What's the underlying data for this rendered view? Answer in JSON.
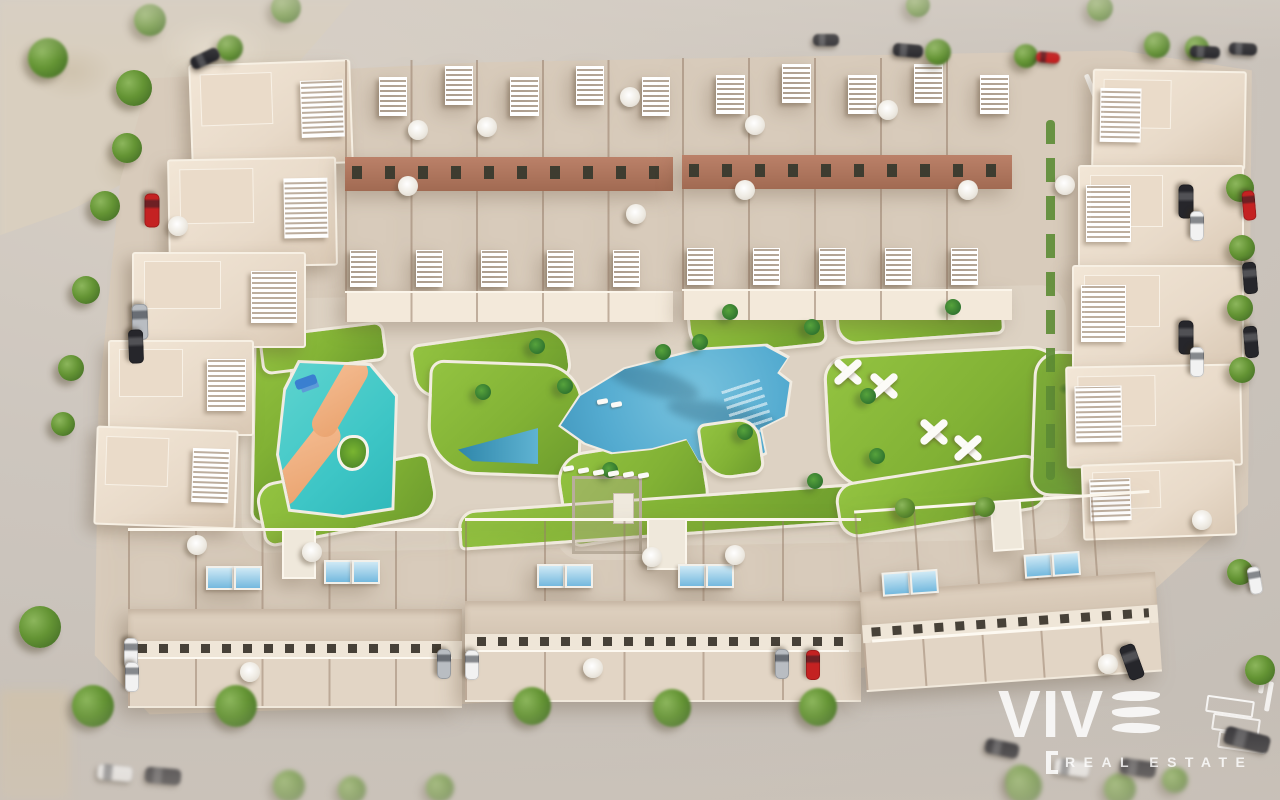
{
  "watermark": {
    "brand": "VIV",
    "tagline": "REAL ESTATE",
    "bracket": "["
  },
  "palette": {
    "street": "#cbc4bc",
    "ground": "#d8cbbb",
    "path": "#ddd2c3",
    "lawn": "#82b235",
    "lawn_light": "#93c341",
    "lawn_dark": "#6d9c2d",
    "pool_blue": "#54abd0",
    "pool_deep": "#3d92b8",
    "kids_pool": "#3ec6c6",
    "kids_river": "#eda877",
    "roof": "#e8dac9",
    "wall": "#f7efe2",
    "facade_terracotta": "#b17c60",
    "window_slot": "#474138",
    "tree_green": "#649434",
    "palm_green": "#31762f",
    "car_black": "#26262b",
    "car_white": "#f2f2f2",
    "car_silver": "#b9bdc2",
    "car_red": "#c42222",
    "watermark_white": "rgba(255,255,255,0.84)"
  },
  "scene": {
    "trees": [
      [
        134,
        88,
        36
      ],
      [
        127,
        148,
        30
      ],
      [
        105,
        206,
        30
      ],
      [
        86,
        290,
        28
      ],
      [
        71,
        368,
        26
      ],
      [
        63,
        424,
        24
      ],
      [
        40,
        627,
        42
      ],
      [
        48,
        58,
        40
      ],
      [
        150,
        20,
        32
      ],
      [
        230,
        48,
        26
      ],
      [
        286,
        8,
        30
      ],
      [
        918,
        5,
        24
      ],
      [
        938,
        52,
        26
      ],
      [
        1026,
        56,
        24
      ],
      [
        1100,
        8,
        26
      ],
      [
        1157,
        45,
        26
      ],
      [
        1197,
        48,
        24
      ],
      [
        1240,
        188,
        28
      ],
      [
        1242,
        248,
        26
      ],
      [
        1240,
        308,
        26
      ],
      [
        1242,
        370,
        26
      ],
      [
        1240,
        572,
        26
      ],
      [
        1260,
        670,
        30
      ],
      [
        905,
        508,
        20
      ],
      [
        985,
        507,
        20
      ],
      [
        93,
        706,
        42
      ],
      [
        236,
        706,
        42
      ],
      [
        289,
        786,
        32
      ],
      [
        352,
        790,
        28
      ],
      [
        440,
        788,
        28
      ],
      [
        532,
        706,
        38
      ],
      [
        672,
        708,
        38
      ],
      [
        818,
        707,
        38
      ],
      [
        1020,
        779,
        28
      ],
      [
        1024,
        786,
        36
      ],
      [
        1120,
        789,
        32
      ],
      [
        1175,
        780,
        26
      ]
    ],
    "palms": [
      [
        565,
        386
      ],
      [
        700,
        342
      ],
      [
        812,
        327
      ],
      [
        868,
        396
      ],
      [
        877,
        456
      ],
      [
        815,
        481
      ],
      [
        745,
        432
      ],
      [
        483,
        392
      ],
      [
        610,
        470
      ],
      [
        537,
        346
      ],
      [
        953,
        307
      ],
      [
        730,
        312
      ],
      [
        663,
        352
      ]
    ],
    "umbrellas": [
      [
        418,
        130
      ],
      [
        487,
        127
      ],
      [
        630,
        97
      ],
      [
        408,
        186
      ],
      [
        636,
        214
      ],
      [
        755,
        125
      ],
      [
        888,
        110
      ],
      [
        968,
        190
      ],
      [
        745,
        190
      ],
      [
        1065,
        185
      ],
      [
        1202,
        520
      ],
      [
        178,
        226
      ],
      [
        197,
        545
      ],
      [
        312,
        552
      ],
      [
        250,
        672
      ],
      [
        652,
        557
      ],
      [
        593,
        668
      ],
      [
        735,
        555
      ],
      [
        1108,
        664
      ]
    ],
    "loungers": [
      [
        563,
        466
      ],
      [
        578,
        468
      ],
      [
        593,
        470
      ],
      [
        608,
        471
      ],
      [
        623,
        472
      ],
      [
        638,
        473
      ],
      [
        597,
        399
      ],
      [
        611,
        402
      ]
    ],
    "cars": [
      [
        152,
        210,
        34,
        15,
        "red",
        90
      ],
      [
        140,
        322,
        36,
        16,
        "silver",
        88
      ],
      [
        136,
        346,
        34,
        15,
        "black",
        88
      ],
      [
        205,
        58,
        30,
        13,
        "black",
        -25
      ],
      [
        826,
        40,
        26,
        12,
        "black",
        0
      ],
      [
        908,
        50,
        30,
        13,
        "black",
        5
      ],
      [
        1048,
        57,
        24,
        11,
        "red",
        5
      ],
      [
        1205,
        52,
        30,
        12,
        "black",
        3
      ],
      [
        1243,
        49,
        28,
        12,
        "black",
        3
      ],
      [
        1186,
        201,
        34,
        15,
        "black",
        90
      ],
      [
        1197,
        226,
        30,
        14,
        "white",
        90
      ],
      [
        1186,
        337,
        34,
        15,
        "black",
        90
      ],
      [
        1197,
        362,
        30,
        14,
        "white",
        90
      ],
      [
        1249,
        205,
        30,
        13,
        "red",
        85
      ],
      [
        1250,
        278,
        32,
        14,
        "black",
        85
      ],
      [
        1251,
        342,
        32,
        14,
        "black",
        85
      ],
      [
        1132,
        662,
        36,
        16,
        "black",
        70
      ],
      [
        1255,
        580,
        28,
        13,
        "white",
        80
      ],
      [
        131,
        653,
        30,
        14,
        "white",
        90
      ],
      [
        132,
        677,
        30,
        14,
        "white",
        90
      ],
      [
        444,
        664,
        30,
        14,
        "silver",
        90
      ],
      [
        472,
        665,
        30,
        14,
        "white",
        90
      ],
      [
        782,
        664,
        30,
        14,
        "silver",
        90
      ],
      [
        813,
        665,
        30,
        14,
        "red",
        90
      ],
      [
        1002,
        748,
        34,
        15,
        "black",
        12
      ],
      [
        1072,
        768,
        36,
        16,
        "white",
        8
      ],
      [
        1138,
        768,
        36,
        16,
        "black",
        8
      ],
      [
        1247,
        740,
        46,
        18,
        "black",
        15
      ],
      [
        115,
        773,
        36,
        16,
        "white",
        5
      ],
      [
        163,
        776,
        36,
        16,
        "black",
        5
      ]
    ],
    "villas": [
      [
        190,
        62,
        158,
        100,
        -2,
        "right"
      ],
      [
        168,
        158,
        165,
        105,
        -1,
        "right"
      ],
      [
        132,
        252,
        170,
        92,
        0,
        "right"
      ],
      [
        108,
        340,
        142,
        92,
        0,
        "right"
      ],
      [
        95,
        428,
        138,
        95,
        2,
        "right"
      ],
      [
        1092,
        70,
        150,
        95,
        1,
        "left"
      ],
      [
        1078,
        165,
        162,
        100,
        0,
        "left"
      ],
      [
        1072,
        265,
        168,
        100,
        0,
        "left"
      ],
      [
        1066,
        365,
        172,
        98,
        -1,
        "left"
      ],
      [
        1082,
        462,
        150,
        72,
        -2,
        "left"
      ]
    ],
    "townhouse_blocks": [
      {
        "x": 345,
        "y": 60,
        "w": 328,
        "h": 262,
        "units": 5
      },
      {
        "x": 682,
        "y": 58,
        "w": 330,
        "h": 262,
        "units": 5
      }
    ],
    "apartment_blocks": [
      {
        "x": 128,
        "y": 528,
        "w": 334,
        "h": 180,
        "a": 0,
        "panels": [
          [
            78,
            38
          ],
          [
            106,
            38
          ],
          [
            196,
            32
          ],
          [
            224,
            32
          ]
        ]
      },
      {
        "x": 465,
        "y": 518,
        "w": 396,
        "h": 184,
        "a": 0,
        "panels": [
          [
            72,
            46
          ],
          [
            100,
            46
          ],
          [
            213,
            46
          ],
          [
            241,
            46
          ]
        ]
      },
      {
        "x": 860,
        "y": 500,
        "w": 296,
        "h": 182,
        "a": -4,
        "panels": [
          [
            23,
            64
          ],
          [
            51,
            64
          ],
          [
            166,
            56
          ],
          [
            194,
            56
          ]
        ]
      }
    ],
    "play_structures": [
      [
        848,
        372
      ],
      [
        884,
        386
      ],
      [
        934,
        432
      ],
      [
        968,
        448
      ]
    ]
  }
}
